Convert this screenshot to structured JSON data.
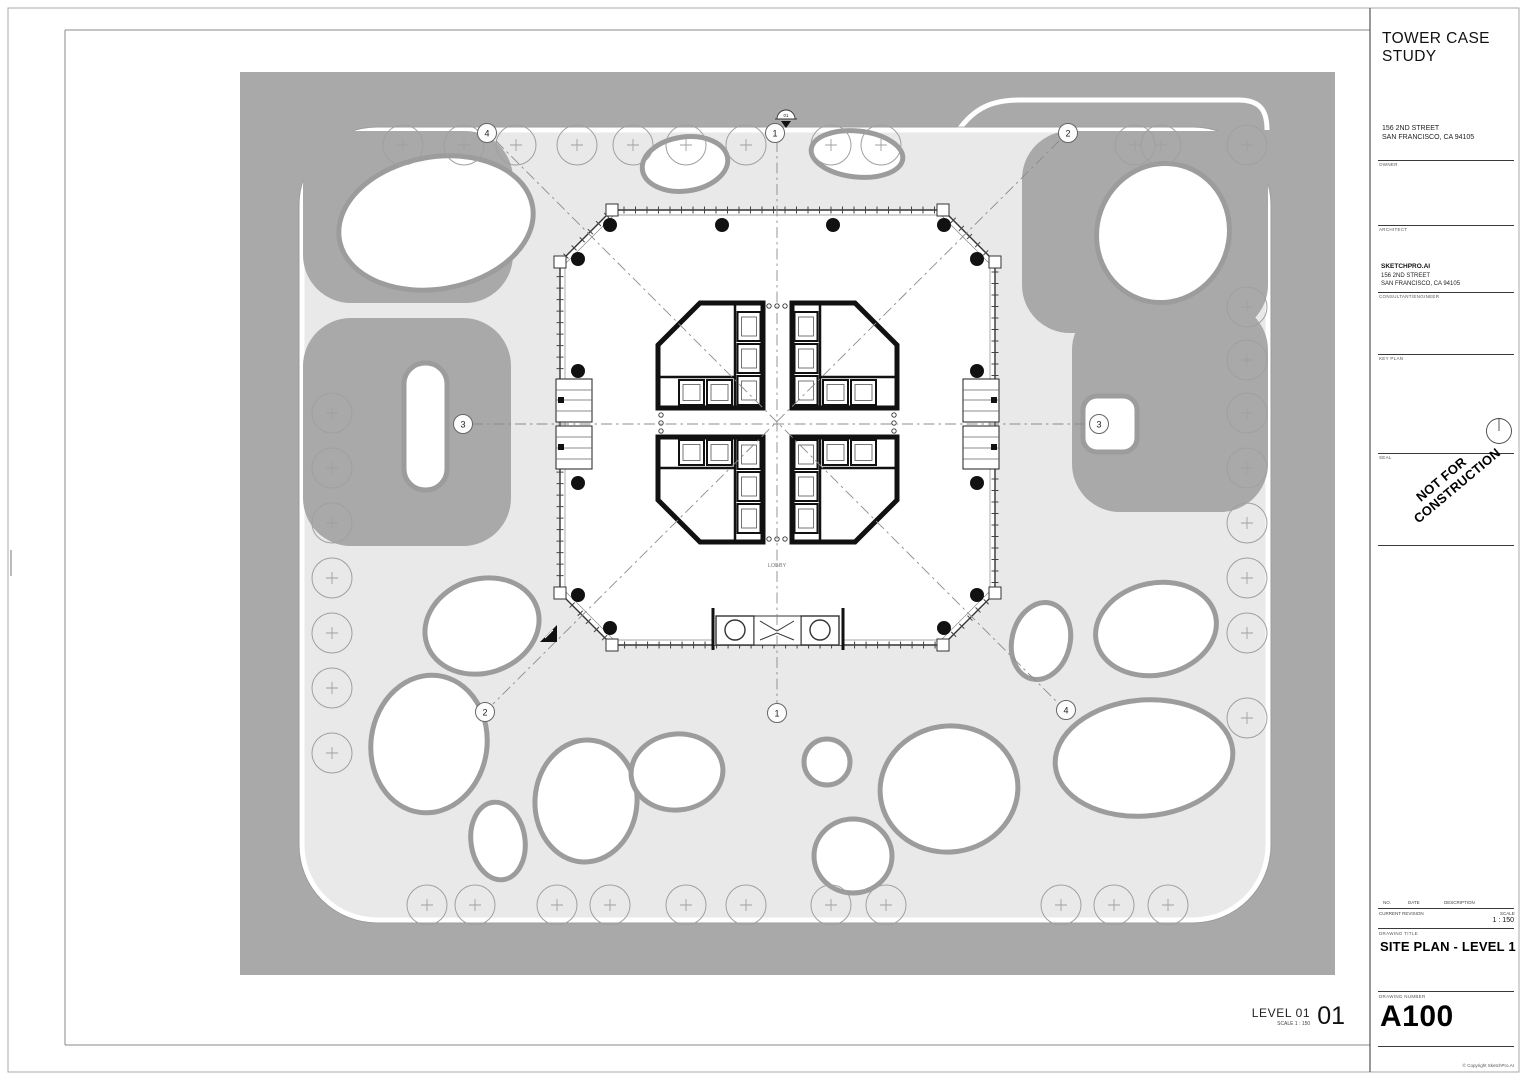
{
  "title_block": {
    "project_title": "TOWER CASE STUDY",
    "address_line1": "156 2ND STREET",
    "address_line2": "SAN FRANCISCO, CA 94105",
    "owner_label": "OWNER",
    "architect_label": "ARCHITECT",
    "architect_name": "SKETCHPRO.AI",
    "architect_address1": "156 2ND STREET",
    "architect_address2": "SAN FRANCISCO, CA 94105",
    "consultant_label": "CONSULTANT/ENGINEER",
    "keyplan_label": "KEY PLAN",
    "seal_label": "SEAL",
    "stamp_text": "NOT FOR CONSTRUCTION",
    "revision": {
      "no_label": "NO.",
      "date_label": "DATE",
      "description_label": "DESCRIPTION",
      "current_revision_label": "CURRENT REVISION",
      "scale_label": "SCALE",
      "scale_value": "1 : 150"
    },
    "drawing_title_label": "DRAWING TITLE",
    "drawing_title": "SITE PLAN - LEVEL 1",
    "drawing_number_label": "DRAWING NUMBER",
    "drawing_number": "A100",
    "copyright": "© Copyright SketchPro.AI"
  },
  "viewport_label": {
    "name": "LEVEL 01",
    "scale": "SCALE    1 : 150",
    "number": "01"
  },
  "plan": {
    "lobby_label": "LOBBY",
    "section_marker_label": "01",
    "style": {
      "ground": "#a9a9a9",
      "plaza": "#e9e9e9",
      "blob_stroke": "#9c9c9c",
      "tree_stroke": "#a0a0a0",
      "grid_stroke": "#8c8c8c",
      "wall": "#111111"
    },
    "trees": [
      [
        403,
        145
      ],
      [
        464,
        145
      ],
      [
        516,
        145
      ],
      [
        577,
        145
      ],
      [
        633,
        145
      ],
      [
        686,
        145
      ],
      [
        746,
        145
      ],
      [
        831,
        145
      ],
      [
        881,
        145
      ],
      [
        1135,
        145
      ],
      [
        1161,
        145
      ],
      [
        1247,
        145
      ],
      [
        332,
        413
      ],
      [
        332,
        468
      ],
      [
        332,
        523
      ],
      [
        332,
        578
      ],
      [
        332,
        633
      ],
      [
        332,
        688
      ],
      [
        332,
        753
      ],
      [
        1247,
        307
      ],
      [
        1247,
        360
      ],
      [
        1247,
        413
      ],
      [
        1247,
        468
      ],
      [
        1247,
        523
      ],
      [
        1247,
        578
      ],
      [
        1247,
        633
      ],
      [
        1247,
        718
      ],
      [
        427,
        905
      ],
      [
        475,
        905
      ],
      [
        557,
        905
      ],
      [
        610,
        905
      ],
      [
        686,
        905
      ],
      [
        746,
        905
      ],
      [
        831,
        905
      ],
      [
        886,
        905
      ],
      [
        1061,
        905
      ],
      [
        1114,
        905
      ],
      [
        1168,
        905
      ]
    ],
    "blobs": [
      {
        "cx": 685,
        "cy": 164,
        "rx": 43,
        "ry": 27,
        "rot": -8
      },
      {
        "cx": 857,
        "cy": 154,
        "rx": 46,
        "ry": 23,
        "rot": 6
      },
      {
        "cx": 436,
        "cy": 223,
        "rx": 98,
        "ry": 66,
        "rot": -10
      },
      {
        "cx": 1163,
        "cy": 233,
        "rx": 66,
        "ry": 70,
        "rot": 20
      },
      {
        "x": 404,
        "y": 363,
        "w": 43,
        "h": 127,
        "r": 21
      },
      {
        "x": 1083,
        "y": 396,
        "w": 54,
        "h": 56,
        "r": 14
      },
      {
        "cx": 482,
        "cy": 626,
        "rx": 58,
        "ry": 47,
        "rot": -18
      },
      {
        "cx": 429,
        "cy": 744,
        "rx": 58,
        "ry": 69,
        "rot": 8
      },
      {
        "cx": 498,
        "cy": 841,
        "rx": 27,
        "ry": 39,
        "rot": -8
      },
      {
        "cx": 586,
        "cy": 801,
        "rx": 51,
        "ry": 61,
        "rot": 4
      },
      {
        "cx": 677,
        "cy": 772,
        "rx": 46,
        "ry": 38,
        "rot": -6
      },
      {
        "cx": 827,
        "cy": 762,
        "rx": 23,
        "ry": 23,
        "rot": 0
      },
      {
        "cx": 853,
        "cy": 856,
        "rx": 39,
        "ry": 37,
        "rot": 0
      },
      {
        "cx": 949,
        "cy": 789,
        "rx": 69,
        "ry": 63,
        "rot": -8
      },
      {
        "cx": 1041,
        "cy": 641,
        "rx": 29,
        "ry": 39,
        "rot": 14
      },
      {
        "cx": 1156,
        "cy": 629,
        "rx": 61,
        "ry": 46,
        "rot": -12
      },
      {
        "cx": 1144,
        "cy": 758,
        "rx": 89,
        "ry": 58,
        "rot": -5
      }
    ],
    "columns": [
      [
        578,
        259
      ],
      [
        610,
        225
      ],
      [
        722,
        225
      ],
      [
        833,
        225
      ],
      [
        944,
        225
      ],
      [
        977,
        259
      ],
      [
        977,
        371
      ],
      [
        977,
        483
      ],
      [
        977,
        595
      ],
      [
        944,
        628
      ],
      [
        833,
        628
      ],
      [
        722,
        628
      ],
      [
        610,
        628
      ],
      [
        578,
        595
      ],
      [
        578,
        483
      ],
      [
        578,
        371
      ]
    ],
    "grid": {
      "lines": [
        [
          777,
          141,
          777,
          704
        ],
        [
          472,
          424,
          1089,
          424
        ],
        [
          496,
          141,
          1056,
          701
        ],
        [
          1059,
          141,
          493,
          704
        ]
      ],
      "bubbles": [
        {
          "label": "4",
          "x": 487,
          "y": 133
        },
        {
          "label": "1",
          "x": 775,
          "y": 133
        },
        {
          "label": "2",
          "x": 1068,
          "y": 133
        },
        {
          "label": "3",
          "x": 463,
          "y": 424
        },
        {
          "label": "3",
          "x": 1099,
          "y": 424
        },
        {
          "label": "2",
          "x": 485,
          "y": 712
        },
        {
          "label": "1",
          "x": 777,
          "y": 713
        },
        {
          "label": "4",
          "x": 1066,
          "y": 710
        }
      ]
    }
  }
}
